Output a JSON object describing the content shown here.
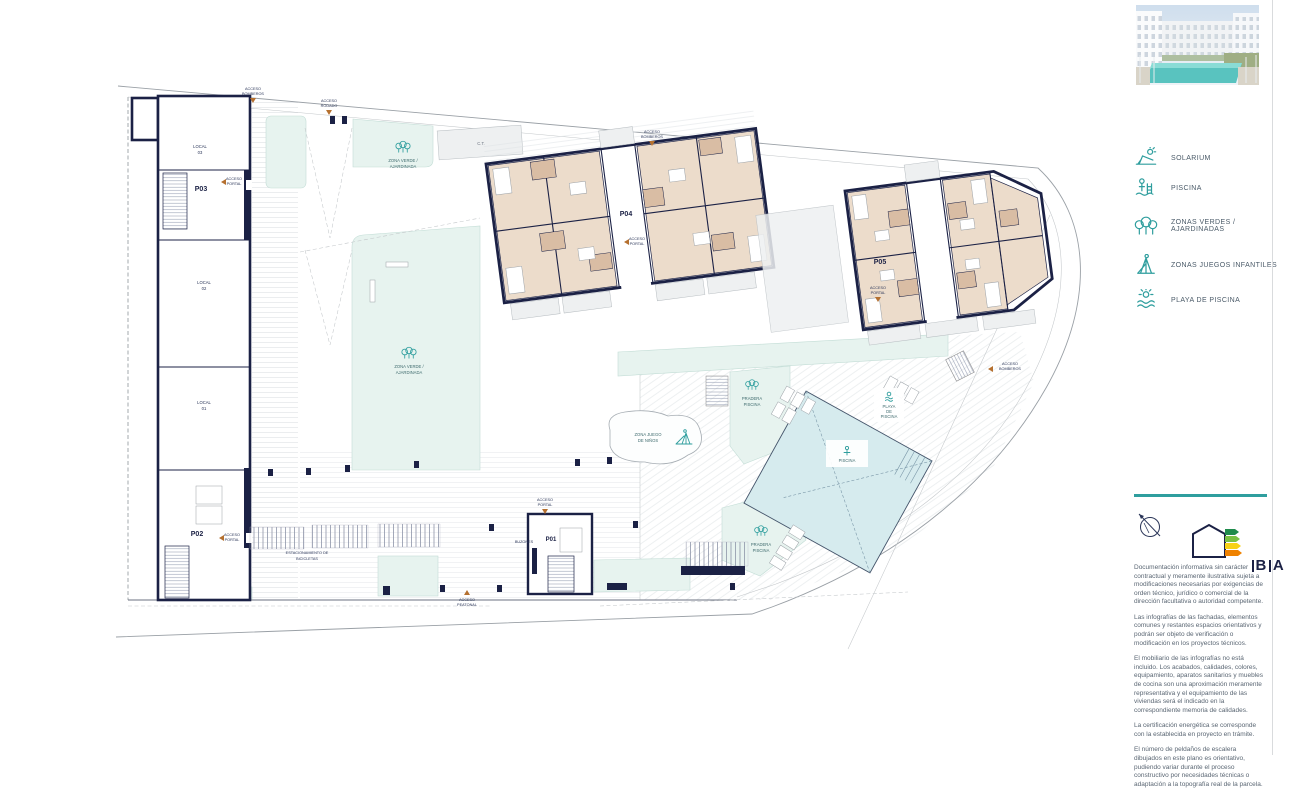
{
  "legend": {
    "items": [
      {
        "icon": "solarium-icon",
        "label": "SOLARIUM"
      },
      {
        "icon": "piscina-icon",
        "label": "PISCINA"
      },
      {
        "icon": "zonas-verdes-icon",
        "label": "ZONAS VERDES / AJARDINADAS"
      },
      {
        "icon": "juegos-infantiles-icon",
        "label": "ZONAS JUEGOS INFANTILES"
      },
      {
        "icon": "playa-piscina-icon",
        "label": "PLAYA DE PISCINA"
      }
    ]
  },
  "plan": {
    "portals": {
      "p01": "P01",
      "p02": "P02",
      "p03": "P03",
      "p04": "P04",
      "p05": "P05"
    },
    "locals": {
      "name": "LOCAL",
      "n1": "01",
      "n2": "02",
      "n3": "03"
    },
    "areas": {
      "zona_verde": [
        "ZONA VERDE /",
        "AJARDINADA"
      ],
      "zona_juegos": [
        "ZONA JUEGO",
        "DE NIÑOS"
      ],
      "pradera": [
        "PRADERA",
        "PISCINA"
      ],
      "playa": [
        "PLAYA",
        "DE",
        "PISCINA"
      ],
      "piscina": "PISCINA",
      "ct": "C.T.",
      "bicicletas": [
        "ESTACIONAMIENTO DE",
        "BICICLETAS"
      ],
      "buzones": "BUZONES"
    },
    "access": {
      "bomberos": [
        "ACCESO",
        "BOMBEROS"
      ],
      "rodado": [
        "ACCESO",
        "RODADO"
      ],
      "portal": [
        "ACCESO",
        "PORTAL"
      ],
      "peatonal": [
        "ACCESO",
        "PEATONAL"
      ]
    }
  },
  "energy": {
    "b": "B",
    "a": "A"
  },
  "footer": {
    "paragraphs": [
      "Documentación informativa sin carácter contractual y meramente ilustrativa sujeta a modificaciones necesarias por exigencias de orden técnico, jurídico o comercial de la dirección facultativa o autoridad competente.",
      "Las infografías de las fachadas, elementos comunes y restantes espacios orientativos y podrán ser objeto de verificación o modificación en los proyectos técnicos.",
      "El mobiliario de las infografías no está incluido. Los acabados, calidades, colores, equipamiento, aparatos sanitarios y muebles de cocina son una aproximación meramente representativa y el equipamiento de las viviendas será el indicado en la correspondiente memoria de calidades.",
      "La certificación energética se corresponde con la establecida en proyecto en trámite.",
      "El número de peldaños de escalera dibujados en este plano es orientativo, pudiendo variar durante el proceso constructivo por necesidades técnicas o adaptación a la topografía real de la parcela."
    ]
  },
  "colors": {
    "accent": "#2f9e9e",
    "wall": "#1b2145",
    "room": "#ecdccb",
    "bath": "#d9bda4",
    "green": "#e7f3ef",
    "pool": "#d6ebee",
    "marker": "#b5702f"
  }
}
